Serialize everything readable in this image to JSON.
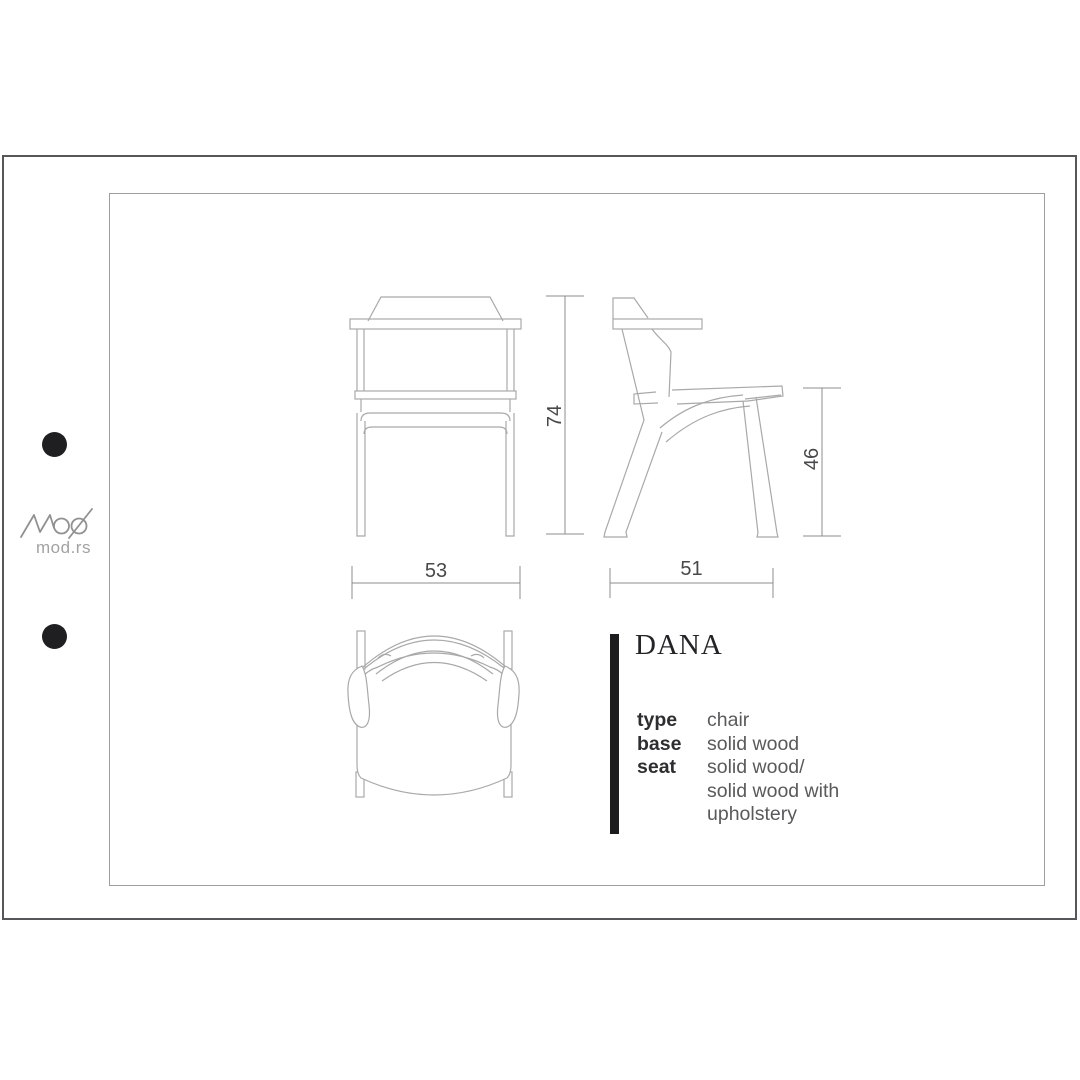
{
  "logo": {
    "brand": "MOD",
    "site": "mod.rs"
  },
  "product": {
    "name": "DANA"
  },
  "spec": {
    "rows": [
      {
        "label": "type",
        "value": "chair"
      },
      {
        "label": "base",
        "value": "solid wood"
      },
      {
        "label": "seat",
        "value": "solid wood/\nsolid wood with\nupholstery"
      }
    ]
  },
  "dimensions": {
    "front_width": "53",
    "total_height": "74",
    "side_depth": "51",
    "seat_height": "46"
  },
  "colors": {
    "chair_line": "#a9a9a9",
    "dimension_line": "#8c8c8c",
    "dimension_text": "#48484a",
    "accent_bar": "#1c1c1e",
    "title_text": "#242427",
    "spec_label_text": "#2e2e30",
    "spec_value_text": "#5a5a5c",
    "logo_gray": "#919191",
    "outer_frame": "#57575a",
    "inner_frame": "#9e9e9e"
  }
}
